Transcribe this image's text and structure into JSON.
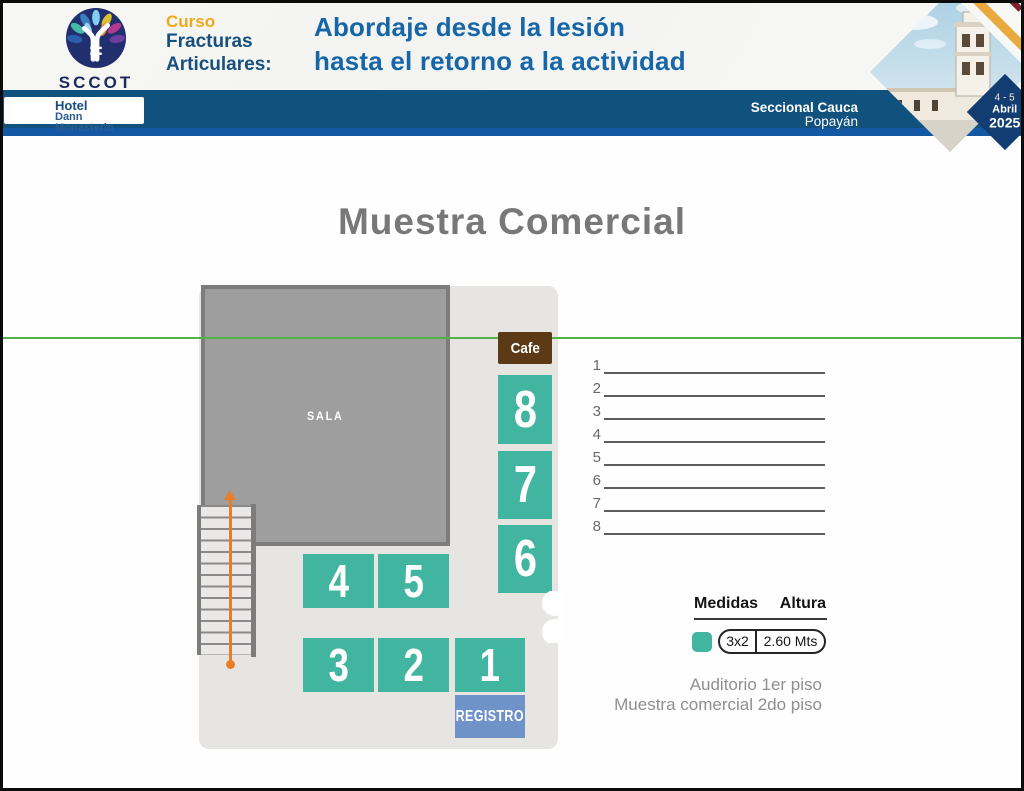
{
  "page": {
    "header": {
      "logo": {
        "acronym": "SCCOT",
        "caption_line1": "SOCIEDAD COLOMBIANA DE CIRUGÍA",
        "caption_line2": "ORTOPÉDICA Y TRAUMATOLOGÍA"
      },
      "course": {
        "kicker": "Curso",
        "name_line1": "Fracturas",
        "name_line2": "Articulares:"
      },
      "title_line1": "Abordaje desde la lesión",
      "title_line2": "hasta el retorno a la actividad",
      "venue": {
        "label": "Hotel",
        "name": "Dann Monasterio"
      },
      "location": {
        "seccional": "Seccional Cauca",
        "city": "Popayán"
      },
      "event_date": {
        "days": "4 - 5",
        "month": "Abril",
        "year": "2025"
      }
    },
    "main": {
      "title": "Muestra Comercial",
      "sala_label": "SALA",
      "cafe_label": "Cafe",
      "registro_label": "REGISTRO",
      "booth_labels": {
        "b1": "1",
        "b2": "2",
        "b3": "3",
        "b4": "4",
        "b5": "5",
        "b6": "6",
        "b7": "7",
        "b8": "8"
      },
      "exhibitor_list": [
        "1",
        "2",
        "3",
        "4",
        "5",
        "6",
        "7",
        "8"
      ],
      "legend": {
        "col_medidas": "Medidas",
        "col_altura": "Altura",
        "size_value": "3x2",
        "height_value": "2.60 Mts"
      },
      "notes_line1": "Auditorio 1er piso",
      "notes_line2": "Muestra comercial 2do piso"
    },
    "colors": {
      "booth_teal": "#41b5a0",
      "registro_blue": "#6f93c8",
      "cafe_brown": "#5d3a16",
      "header_bar": "#11517e",
      "header_bar_accent": "#1458a3",
      "title_blue": "#1766a8",
      "kicker_yellow": "#f2a81d",
      "green_line": "#53b24c",
      "stairs_orange": "#e87f28"
    }
  }
}
